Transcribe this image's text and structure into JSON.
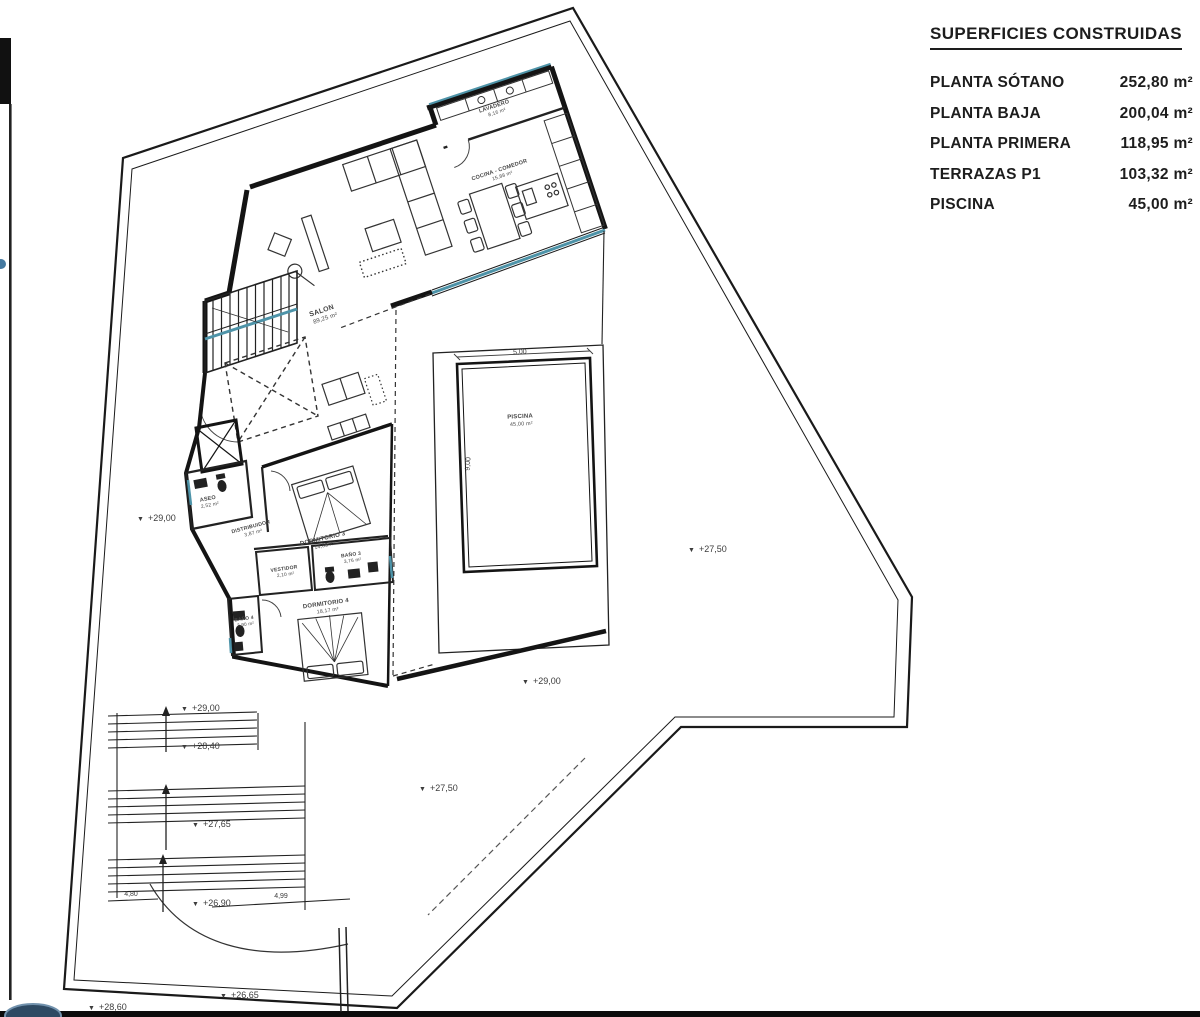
{
  "legend": {
    "title": "SUPERFICIES CONSTRUIDAS",
    "rows": [
      {
        "label": "PLANTA SÓTANO",
        "value": "252,80 m²"
      },
      {
        "label": "PLANTA BAJA",
        "value": "200,04 m²"
      },
      {
        "label": "PLANTA PRIMERA",
        "value": "118,95 m²"
      },
      {
        "label": "TERRAZAS P1",
        "value": "103,32 m²"
      },
      {
        "label": "PISCINA",
        "value": "45,00 m²"
      }
    ]
  },
  "rooms": {
    "salon": {
      "name": "SALON",
      "area": "89,25 m²"
    },
    "lavadero": {
      "name": "LAVADERO",
      "area": "8,16 m²"
    },
    "cocina": {
      "name": "COCINA - COMEDOR",
      "area": "15,88 m²"
    },
    "aseo": {
      "name": "ASEO",
      "area": "2,52 m²"
    },
    "distribuidor": {
      "name": "DISTRIBUIDOR",
      "area": "3,87 m²"
    },
    "dormitorio3": {
      "name": "DORMITORIO 3",
      "area": "14,85 m²"
    },
    "vestidor": {
      "name": "VESTIDOR",
      "area": "2,10 m²"
    },
    "bano3": {
      "name": "BAÑO 3",
      "area": "3,76 m²"
    },
    "dormitorio4": {
      "name": "DORMITORIO 4",
      "area": "18,17 m²"
    },
    "bano4": {
      "name": "BAÑO 4",
      "area": "3,90 m²"
    },
    "piscina": {
      "name": "PISCINA",
      "area": "45,00 m²"
    }
  },
  "elevations": {
    "left": "+29,00",
    "right": "+27,50",
    "pool_bottom": "+29,00",
    "stairs_top": "+29,00",
    "stairs_mid": "+28,40",
    "stairs_lower": "+27,65",
    "stairs_bottom": "+26,90",
    "terrace": "+27,50",
    "site_low": "+26,65",
    "site_edge": "+28,60"
  },
  "dimensions": {
    "pool_width": "5,00",
    "pool_height": "9,00",
    "steps_width": "4,80",
    "walk_width": "4,99"
  },
  "glyphs": {
    "level_marker": "▼"
  },
  "colors": {
    "wall": "#141414",
    "accent_teal": "#4d93a8",
    "label_grey": "#474747",
    "logo_blue": "#2e4a63"
  }
}
